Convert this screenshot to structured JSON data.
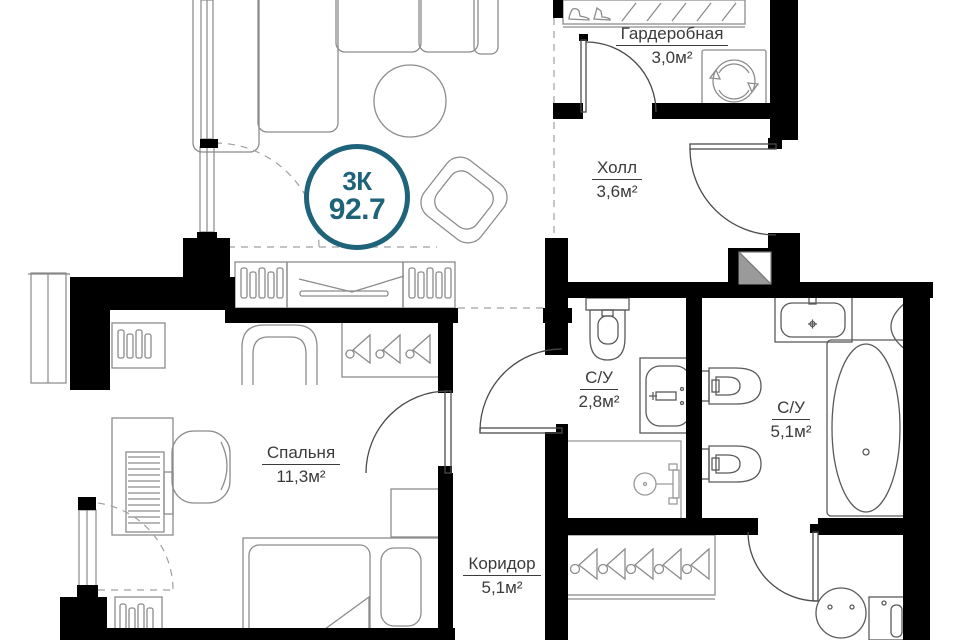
{
  "badge": {
    "rooms_label": "3К",
    "total_area": "92.7",
    "accent_color": "#1f637b"
  },
  "rooms": [
    {
      "id": "wardrobe",
      "name": "Гардеробная",
      "area": "3,0м²"
    },
    {
      "id": "hall",
      "name": "Холл",
      "area": "3,6м²"
    },
    {
      "id": "bathroom_small",
      "name": "С/У",
      "area": "2,8м²"
    },
    {
      "id": "bathroom_large",
      "name": "С/У",
      "area": "5,1м²"
    },
    {
      "id": "bedroom",
      "name": "Спальня",
      "area": "11,3м²"
    },
    {
      "id": "corridor",
      "name": "Коридор",
      "area": "5,1м²"
    }
  ],
  "colors": {
    "wall": "#000000",
    "furniture_line": "#8c8c8c",
    "fixture_line": "#5a5a5a",
    "door_line": "#4a4a4a",
    "dashed_line": "#a0a0a0",
    "text": "#3b3b3b"
  }
}
